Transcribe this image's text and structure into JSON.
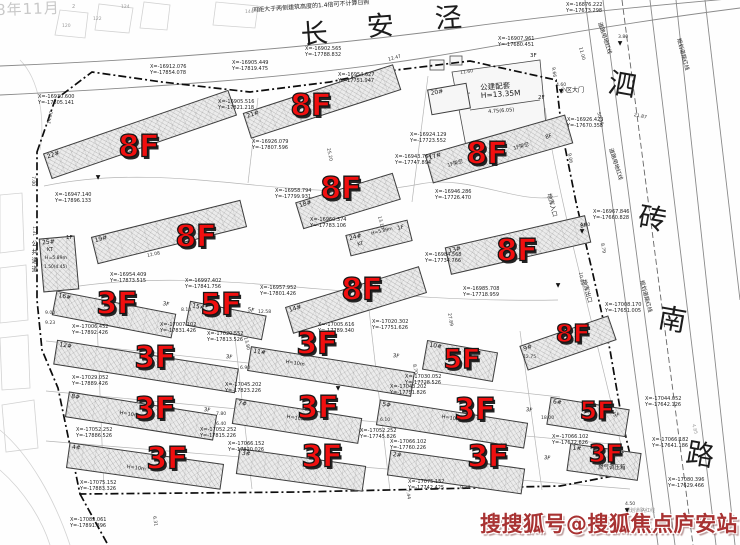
{
  "watermarks": {
    "brand": "搜搜狐号@搜狐焦点庐安站",
    "date_fragment": "8年11月"
  },
  "roads": {
    "top": "长安泾",
    "right": "泗砖南路"
  },
  "notes": {
    "sunlight_note": "间距大于两侧建筑高度的1.4倍可不计算日照"
  },
  "colors": {
    "floor_red": "#f10f0f",
    "watermark_red": "#a83232",
    "line_gray": "#8a8a8a",
    "boundary_black": "#0d0d0d"
  },
  "buildings": [
    {
      "num": "22#",
      "floors": "8F",
      "cx": 140,
      "cy": 134,
      "w": 196,
      "h": 27,
      "rot": -19,
      "lx": 139,
      "ly": 148,
      "ls": 30
    },
    {
      "num": "21#",
      "floors": "8F",
      "cx": 322,
      "cy": 101,
      "w": 158,
      "h": 27,
      "rot": -18,
      "lx": 311,
      "ly": 107,
      "ls": 30
    },
    {
      "num": "17#",
      "floors": "8F",
      "cx": 499,
      "cy": 149,
      "w": 146,
      "h": 30,
      "rot": -16,
      "lx": 487,
      "ly": 155,
      "ls": 30
    },
    {
      "num": "18#",
      "floors": "8F",
      "cx": 348,
      "cy": 201,
      "w": 102,
      "h": 28,
      "rot": -17,
      "lx": 341,
      "ly": 190,
      "ls": 30
    },
    {
      "num": "19#",
      "floors": "8F",
      "cx": 169,
      "cy": 232,
      "w": 154,
      "h": 28,
      "rot": -14,
      "lx": 196,
      "ly": 238,
      "ls": 30
    },
    {
      "num": "13#",
      "floors": "8F",
      "cx": 518,
      "cy": 245,
      "w": 144,
      "h": 28,
      "rot": -13,
      "lx": 517,
      "ly": 252,
      "ls": 30
    },
    {
      "num": "14#",
      "floors": "8F",
      "cx": 356,
      "cy": 300,
      "w": 140,
      "h": 28,
      "rot": -17,
      "lx": 362,
      "ly": 291,
      "ls": 30
    },
    {
      "num": "9#",
      "floors": "8F",
      "cx": 568,
      "cy": 343,
      "w": 94,
      "h": 26,
      "rot": -19,
      "lx": 573,
      "ly": 334,
      "ls": 25
    },
    {
      "num": "16#",
      "floors": "3F",
      "cx": 114,
      "cy": 314,
      "w": 122,
      "h": 25,
      "rot": 11,
      "lx": 117,
      "ly": 305,
      "ls": 30
    },
    {
      "num": "15#",
      "floors": "5F",
      "cx": 226,
      "cy": 320,
      "w": 78,
      "h": 25,
      "rot": 11,
      "lx": 221,
      "ly": 306,
      "ls": 30
    },
    {
      "num": "12#",
      "floors": "3F",
      "cx": 146,
      "cy": 366,
      "w": 184,
      "h": 25,
      "rot": 9,
      "lx": 155,
      "ly": 359,
      "ls": 30
    },
    {
      "num": "11#",
      "floors": "3F",
      "cx": 331,
      "cy": 371,
      "w": 166,
      "h": 25,
      "rot": 9,
      "lx": 317,
      "ly": 345,
      "ls": 30
    },
    {
      "num": "10#",
      "floors": "5F",
      "cx": 460,
      "cy": 361,
      "w": 72,
      "h": 30,
      "rot": 10,
      "lx": 462,
      "ly": 360,
      "ls": 27
    },
    {
      "num": "8#",
      "floors": "3F",
      "cx": 141,
      "cy": 416,
      "w": 150,
      "h": 26,
      "rot": 9,
      "lx": 155,
      "ly": 410,
      "ls": 30
    },
    {
      "num": "7#",
      "floors": "3F",
      "cx": 297,
      "cy": 421,
      "w": 128,
      "h": 26,
      "rot": 9,
      "lx": 318,
      "ly": 409,
      "ls": 30
    },
    {
      "num": "5#",
      "floors": "3F",
      "cx": 452,
      "cy": 424,
      "w": 150,
      "h": 26,
      "rot": 9,
      "lx": 475,
      "ly": 411,
      "ls": 30
    },
    {
      "num": "6#",
      "floors": "5F",
      "cx": 588,
      "cy": 417,
      "w": 80,
      "h": 28,
      "rot": 9,
      "lx": 597,
      "ly": 411,
      "ls": 25
    },
    {
      "num": "4#",
      "floors": "3F",
      "cx": 145,
      "cy": 466,
      "w": 156,
      "h": 26,
      "rot": 8,
      "lx": 167,
      "ly": 460,
      "ls": 30
    },
    {
      "num": "3#",
      "floors": "3F",
      "cx": 301,
      "cy": 470,
      "w": 128,
      "h": 26,
      "rot": 8,
      "lx": 322,
      "ly": 458,
      "ls": 30
    },
    {
      "num": "2#",
      "floors": "3F",
      "cx": 456,
      "cy": 472,
      "w": 136,
      "h": 26,
      "rot": 8,
      "lx": 488,
      "ly": 458,
      "ls": 30
    },
    {
      "num": "1#",
      "floors": "3F",
      "cx": 604,
      "cy": 462,
      "w": 72,
      "h": 28,
      "rot": 8,
      "lx": 606,
      "ly": 454,
      "ls": 25
    }
  ],
  "small_buildings": [
    {
      "num": "20#",
      "cx": 449,
      "cy": 99,
      "w": 40,
      "h": 26,
      "rot": -10,
      "hatch": false
    },
    {
      "num": "24#",
      "cx": 379,
      "cy": 238,
      "w": 64,
      "h": 22,
      "rot": -14,
      "hatch": true
    },
    {
      "num": "25#",
      "cx": 59,
      "cy": 264,
      "w": 36,
      "h": 54,
      "rot": -5,
      "hatch": true
    }
  ],
  "coord_labels": [
    {
      "x": "X=-16912.076",
      "y": "Y=-17854.078",
      "px": 150,
      "py": 70
    },
    {
      "x": "X=-16930.600",
      "y": "Y=-17805.141",
      "px": 38,
      "py": 100
    },
    {
      "x": "X=-16905.449",
      "y": "Y=-17819.475",
      "px": 232,
      "py": 66
    },
    {
      "x": "X=-16902.565",
      "y": "Y=-17788.832",
      "px": 305,
      "py": 52
    },
    {
      "x": "X=-16876.222",
      "y": "Y=-17673.298",
      "px": 566,
      "py": 8
    },
    {
      "x": "X=-16954.627",
      "y": "Y=-17751.947",
      "px": 338,
      "py": 78
    },
    {
      "x": "X=-16926.079",
      "y": "Y=-17807.596",
      "px": 252,
      "py": 145
    },
    {
      "x": "X=-16947.140",
      "y": "Y=-17896.133",
      "px": 55,
      "py": 198
    },
    {
      "x": "X=-16954.409",
      "y": "Y=-17873.515",
      "px": 110,
      "py": 278
    },
    {
      "x": "X=-16958.794",
      "y": "Y=-17799.931",
      "px": 275,
      "py": 194
    },
    {
      "x": "X=-16960.374",
      "y": "Y=-17783.106",
      "px": 310,
      "py": 223
    },
    {
      "x": "X=-16957.952",
      "y": "Y=-17801.426",
      "px": 260,
      "py": 291
    },
    {
      "x": "X=-16943.764",
      "y": "Y=-17747.894",
      "px": 395,
      "py": 160
    },
    {
      "x": "X=-16946.286",
      "y": "Y=-17726.470",
      "px": 435,
      "py": 195
    },
    {
      "x": "X=-16924.129",
      "y": "Y=-17723.552",
      "px": 410,
      "py": 138
    },
    {
      "x": "X=-16926.423",
      "y": "Y=-17670.358",
      "px": 567,
      "py": 123
    },
    {
      "x": "X=-16985.708",
      "y": "Y=-17718.959",
      "px": 463,
      "py": 292
    },
    {
      "x": "X=-16984.568",
      "y": "Y=-17734.766",
      "px": 425,
      "py": 258
    },
    {
      "x": "X=-16997.402",
      "y": "Y=-17841.756",
      "px": 185,
      "py": 284
    },
    {
      "x": "X=-17005.616",
      "y": "Y=-17789.340",
      "px": 318,
      "py": 328
    },
    {
      "x": "X=-17020.302",
      "y": "Y=-17751.626",
      "px": 372,
      "py": 325
    },
    {
      "x": "X=-17043.202",
      "y": "Y=-17751.826",
      "px": 390,
      "py": 390
    },
    {
      "x": "X=-17030.052",
      "y": "Y=-17728.526",
      "px": 405,
      "py": 380
    },
    {
      "x": "X=-17006.452",
      "y": "Y=-17892.426",
      "px": 72,
      "py": 330
    },
    {
      "x": "X=-17007.102",
      "y": "Y=-17831.426",
      "px": 160,
      "py": 328
    },
    {
      "x": "X=-17020.552",
      "y": "Y=-17813.526",
      "px": 207,
      "py": 337
    },
    {
      "x": "X=-17029.052",
      "y": "Y=-17889.426",
      "px": 72,
      "py": 381
    },
    {
      "x": "X=-17045.202",
      "y": "Y=-17823.226",
      "px": 225,
      "py": 388
    },
    {
      "x": "X=-17052.252",
      "y": "Y=-17886.526",
      "px": 76,
      "py": 433
    },
    {
      "x": "X=-17052.252",
      "y": "Y=-17815.226",
      "px": 200,
      "py": 433
    },
    {
      "x": "X=-17066.152",
      "y": "Y=-17820.026",
      "px": 228,
      "py": 447
    },
    {
      "x": "X=-17075.152",
      "y": "Y=-17883.326",
      "px": 80,
      "py": 486
    },
    {
      "x": "X=-17083.061",
      "y": "Y=-17891.896",
      "px": 70,
      "py": 523
    },
    {
      "x": "X=-17052.252",
      "y": "Y=-17745.826",
      "px": 360,
      "py": 434
    },
    {
      "x": "X=-17066.102",
      "y": "Y=-17760.226",
      "px": 390,
      "py": 445
    },
    {
      "x": "X=-17075.152",
      "y": "Y=-17742.425",
      "px": 408,
      "py": 485
    },
    {
      "x": "X=-17066.102",
      "y": "Y=-17672.626",
      "px": 552,
      "py": 440
    },
    {
      "x": "X=-17044.052",
      "y": "Y=-17642.126",
      "px": 645,
      "py": 402
    },
    {
      "x": "X=-17066.182",
      "y": "Y=-17641.186",
      "px": 652,
      "py": 443
    },
    {
      "x": "X=-17080.396",
      "y": "Y=-17629.466",
      "px": 668,
      "py": 483
    },
    {
      "x": "X=-17008.170",
      "y": "Y=-17651.005",
      "px": 605,
      "py": 308
    },
    {
      "x": "X=-16967.846",
      "y": "Y=-17660.828",
      "px": 593,
      "py": 215
    },
    {
      "x": "X=-16907.961",
      "y": "Y=-17680.451",
      "px": 498,
      "py": 42
    },
    {
      "x": "X=-16905.516",
      "y": "Y=-17821.218",
      "px": 218,
      "py": 105
    }
  ],
  "misc_labels": [
    {
      "t": "间距大于两侧建筑高度的1.4倍可不计算日照",
      "px": 252,
      "py": 8,
      "s": 6,
      "r": -4
    },
    {
      "t": "长",
      "px": 300,
      "py": 22,
      "s": 27,
      "r": -4
    },
    {
      "t": "安",
      "px": 366,
      "py": 14,
      "s": 27,
      "r": -4
    },
    {
      "t": "泾",
      "px": 434,
      "py": 6,
      "s": 27,
      "r": -4
    },
    {
      "t": "泗",
      "px": 611,
      "py": 68,
      "s": 28,
      "r": 10
    },
    {
      "t": "砖",
      "px": 641,
      "py": 202,
      "s": 28,
      "r": 10
    },
    {
      "t": "南",
      "px": 661,
      "py": 303,
      "s": 28,
      "r": 10
    },
    {
      "t": "路",
      "px": 689,
      "py": 438,
      "s": 28,
      "r": 10
    },
    {
      "t": "小区大门",
      "px": 560,
      "py": 88,
      "s": 6,
      "r": 0
    },
    {
      "t": "道路用地红线",
      "px": 601,
      "py": 22,
      "s": 5.5,
      "r": 72
    },
    {
      "t": "道路用地红线",
      "px": 612,
      "py": 148,
      "s": 5.5,
      "r": 72
    },
    {
      "t": "地库入口",
      "px": 551,
      "py": 193,
      "s": 6,
      "r": 75
    },
    {
      "t": "地库出口",
      "px": 586,
      "py": 279,
      "s": 6,
      "r": 75
    },
    {
      "t": "规划道路红线",
      "px": 680,
      "py": 38,
      "s": 5.5,
      "r": 75
    },
    {
      "t": "规划道路红线",
      "px": 643,
      "py": 280,
      "s": 5.5,
      "r": 75
    },
    {
      "t": "规划道路红线",
      "px": 625,
      "py": 509,
      "s": 5,
      "r": 0,
      "c": "#8a8a8a"
    },
    {
      "t": "燃气调压箱",
      "px": 598,
      "py": 466,
      "s": 5.5,
      "r": 0
    },
    {
      "t": "公共通道",
      "px": 30,
      "py": 240,
      "s": 6.5,
      "r": 0,
      "v": true
    },
    {
      "t": "公建配套\nH=13.35M",
      "px": 480,
      "py": 84,
      "s": 7.5,
      "r": -4
    },
    {
      "t": "4.75(6.05)",
      "px": 488,
      "py": 110,
      "s": 5,
      "r": -4
    },
    {
      "t": "3F",
      "px": 530,
      "py": 54,
      "s": 5.5,
      "r": 0
    },
    {
      "t": "2F",
      "px": 538,
      "py": 96,
      "s": 5.5,
      "r": 0
    },
    {
      "t": "1F架空",
      "px": 447,
      "py": 164,
      "s": 5,
      "r": -16
    },
    {
      "t": "1F架空",
      "px": 513,
      "py": 147,
      "s": 5,
      "r": -16
    },
    {
      "t": "H=10m",
      "px": 120,
      "py": 411,
      "s": 5,
      "r": 9
    },
    {
      "t": "H=10m",
      "px": 286,
      "py": 360,
      "s": 5,
      "r": 9
    },
    {
      "t": "H=10m",
      "px": 287,
      "py": 415,
      "s": 5,
      "r": 9
    },
    {
      "t": "H=10m",
      "px": 442,
      "py": 415,
      "s": 5,
      "r": 9
    },
    {
      "t": "H=10m",
      "px": 127,
      "py": 465,
      "s": 5,
      "r": 8
    },
    {
      "t": "KT",
      "px": 357,
      "py": 243,
      "s": 5,
      "r": -14
    },
    {
      "t": "H=5.89m",
      "px": 371,
      "py": 233,
      "s": 4.6,
      "r": -14
    },
    {
      "t": "1F",
      "px": 397,
      "py": 227,
      "s": 5.5,
      "r": -14
    },
    {
      "t": "1F",
      "px": 66,
      "py": 236,
      "s": 5.5,
      "r": 0
    },
    {
      "t": "KT",
      "px": 47,
      "py": 248,
      "s": 5,
      "r": 0
    },
    {
      "t": "H=5.89m",
      "px": 45,
      "py": 257,
      "s": 4.6,
      "r": 0
    },
    {
      "t": "1.50(4.45)",
      "px": 44,
      "py": 266,
      "s": 4.4,
      "r": 0
    },
    {
      "t": "8F",
      "px": 545,
      "py": 136,
      "s": 5.5,
      "r": -16
    },
    {
      "t": "8F",
      "px": 580,
      "py": 225,
      "s": 5.5,
      "r": -13
    },
    {
      "t": "3F",
      "px": 163,
      "py": 302,
      "s": 5.5,
      "r": 11
    },
    {
      "t": "5F",
      "px": 248,
      "py": 308,
      "s": 5.5,
      "r": 11
    },
    {
      "t": "3F",
      "px": 226,
      "py": 355,
      "s": 5.5,
      "r": 9
    },
    {
      "t": "3F",
      "px": 393,
      "py": 354,
      "s": 5.5,
      "r": 9
    },
    {
      "t": "3F",
      "px": 204,
      "py": 408,
      "s": 5.5,
      "r": 9
    },
    {
      "t": "3F",
      "px": 526,
      "py": 408,
      "s": 5.5,
      "r": 9
    },
    {
      "t": "5F",
      "px": 613,
      "py": 413,
      "s": 5.5,
      "r": 9
    },
    {
      "t": "3F",
      "px": 544,
      "py": 456,
      "s": 5.5,
      "r": 8
    },
    {
      "t": "3F",
      "px": 618,
      "py": 451,
      "s": 5.5,
      "r": 8
    },
    {
      "t": "2",
      "px": 72,
      "py": 5,
      "s": 5,
      "r": 0,
      "c": "#9a9a9a"
    },
    {
      "t": "120",
      "px": 62,
      "py": 25,
      "s": 4.5,
      "r": 0,
      "c": "#9a9a9a"
    },
    {
      "t": "122",
      "px": 93,
      "py": 18,
      "s": 4.5,
      "r": 0,
      "c": "#9a9a9a"
    },
    {
      "t": "124",
      "px": 121,
      "py": 6,
      "s": 4.5,
      "r": 0,
      "c": "#9a9a9a"
    },
    {
      "t": "144",
      "px": 245,
      "py": 11,
      "s": 4.5,
      "r": 0,
      "c": "#9a9a9a"
    }
  ],
  "dims": [
    {
      "t": "12.47",
      "px": 388,
      "py": 59,
      "r": -15
    },
    {
      "t": "14.00",
      "px": 48,
      "py": 124,
      "r": -78
    },
    {
      "t": "7.00",
      "px": 34,
      "py": 176,
      "r": 90
    },
    {
      "t": "1.31",
      "px": 35,
      "py": 226,
      "r": 90
    },
    {
      "t": "11.60",
      "px": 460,
      "py": 72,
      "r": -8
    },
    {
      "t": "9.66",
      "px": 554,
      "py": 67,
      "r": 82
    },
    {
      "t": "4.60",
      "px": 556,
      "py": 84,
      "r": 0
    },
    {
      "t": "3.80",
      "px": 618,
      "py": 36,
      "r": 0
    },
    {
      "t": "11.00",
      "px": 581,
      "py": 47,
      "r": 75
    },
    {
      "t": "21.87",
      "px": 634,
      "py": 114,
      "r": 12
    },
    {
      "t": "50.35",
      "px": 599,
      "py": 112,
      "r": 75
    },
    {
      "t": "9.06",
      "px": 570,
      "py": 153,
      "r": 80
    },
    {
      "t": "8.79",
      "px": 603,
      "py": 243,
      "r": 80
    },
    {
      "t": "4.60",
      "px": 580,
      "py": 224,
      "r": 0
    },
    {
      "t": "25.20",
      "px": 329,
      "py": 148,
      "r": 78
    },
    {
      "t": "12.08",
      "px": 147,
      "py": 255,
      "r": -12
    },
    {
      "t": "13.10",
      "px": 380,
      "py": 216,
      "r": 76
    },
    {
      "t": "27.89",
      "px": 450,
      "py": 313,
      "r": 80
    },
    {
      "t": "8.10",
      "px": 181,
      "py": 309,
      "r": 0
    },
    {
      "t": "12.58",
      "px": 258,
      "py": 311,
      "r": 0
    },
    {
      "t": "9.00",
      "px": 45,
      "py": 312,
      "r": 0
    },
    {
      "t": "9.23",
      "px": 45,
      "py": 322,
      "r": 0
    },
    {
      "t": "6.90",
      "px": 240,
      "py": 367,
      "r": 0
    },
    {
      "t": "13.80",
      "px": 246,
      "py": 337,
      "r": 76
    },
    {
      "t": "7.80",
      "px": 216,
      "py": 413,
      "r": 0
    },
    {
      "t": "6.40",
      "px": 216,
      "py": 423,
      "r": 0
    },
    {
      "t": "6.10",
      "px": 380,
      "py": 419,
      "r": 0
    },
    {
      "t": "18.00",
      "px": 541,
      "py": 417,
      "r": 0
    },
    {
      "t": "8.70",
      "px": 415,
      "py": 364,
      "r": 80
    },
    {
      "t": "10.85",
      "px": 581,
      "py": 272,
      "r": 80
    },
    {
      "t": "12.75",
      "px": 523,
      "py": 356,
      "r": 0
    },
    {
      "t": "4.85",
      "px": 694,
      "py": 424,
      "r": 75,
      "c": "#9a9a9a"
    },
    {
      "t": "9.37",
      "px": 460,
      "py": 487,
      "r": 0
    },
    {
      "t": "7.44",
      "px": 408,
      "py": 489,
      "r": 80
    },
    {
      "t": "6.31",
      "px": 155,
      "py": 516,
      "r": 80
    },
    {
      "t": "6.47",
      "px": 590,
      "py": 516,
      "r": 80
    },
    {
      "t": "4.50",
      "px": 625,
      "py": 503,
      "r": 0
    }
  ],
  "markers": [
    {
      "px": 561,
      "py": 92
    },
    {
      "px": 620,
      "py": 44
    },
    {
      "px": 582,
      "py": 232
    },
    {
      "px": 558,
      "py": 286
    },
    {
      "px": 627,
      "py": 511
    },
    {
      "px": 338,
      "py": 389
    },
    {
      "px": 98,
      "py": 178
    }
  ]
}
